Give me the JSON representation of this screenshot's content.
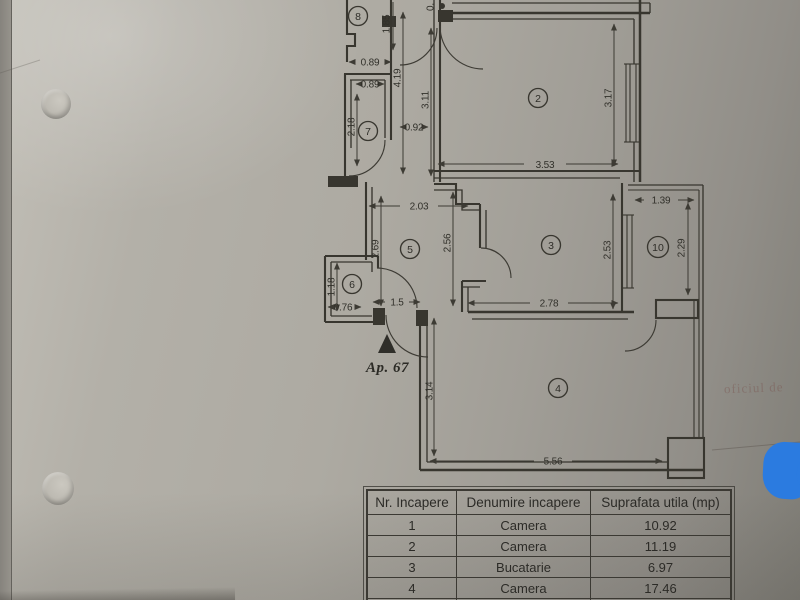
{
  "plan": {
    "apartment_label": "Ap. 67",
    "entrance_marker": "▲",
    "partial_top_dimension": "0.",
    "bleed_through_text": "oficiul de",
    "room_numbers": {
      "r8": "8",
      "r7": "7",
      "r2": "2",
      "r5": "5",
      "r6": "6",
      "r3": "3",
      "r10": "10",
      "r4": "4"
    },
    "dimensions": {
      "d185": "1.85",
      "d089a": "0.89",
      "d089b": "0.89",
      "d419": "4.19",
      "d311": "3.11",
      "d218": "2.18",
      "d092": "0.92",
      "d353": "3.53",
      "d317": "3.17",
      "d203": "2.03",
      "d269": "2.69",
      "d256": "2.56",
      "d139": "1.39",
      "d253": "2.53",
      "d229": "2.29",
      "d278": "2.78",
      "d118": "1.18",
      "d076": "0.76",
      "d15": "1.5",
      "d314": "3.14",
      "d556": "5.56"
    }
  },
  "table": {
    "headers": {
      "nr": "Nr. Incapere",
      "name": "Denumire incapere",
      "area": "Suprafata utila (mp)"
    },
    "rows": [
      {
        "nr": "1",
        "name": "Camera",
        "area": "10.92"
      },
      {
        "nr": "2",
        "name": "Camera",
        "area": "11.19"
      },
      {
        "nr": "3",
        "name": "Bucatarie",
        "area": "6.97"
      },
      {
        "nr": "4",
        "name": "Camera",
        "area": "17.46"
      }
    ]
  },
  "colors": {
    "ink": "#38362f",
    "paper": "#adaaa2",
    "sticker_blue": "#2b7be0"
  }
}
